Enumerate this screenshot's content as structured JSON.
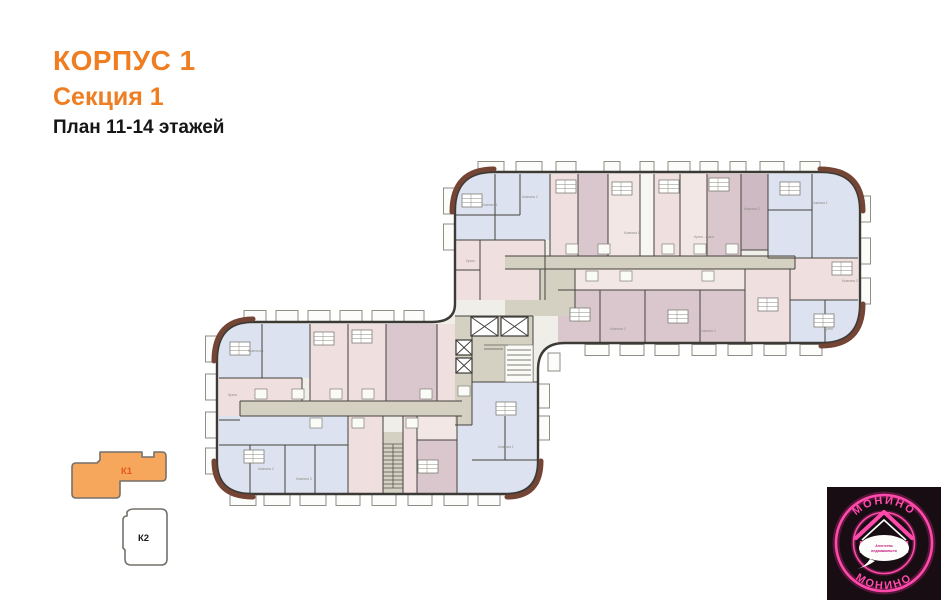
{
  "header": {
    "building": "КОРПУС 1",
    "section": "Секция 1",
    "floors": "План 11-14 этажей"
  },
  "minimap": {
    "k1_label": "К1",
    "k2_label": "К2"
  },
  "logo": {
    "arc_top": "МОНИНО",
    "arc_bottom": "МОНИНО",
    "tagline_line1": "Агентство",
    "tagline_line2": "недвижимости"
  },
  "plan": {
    "room_labels": [
      "Комната 1",
      "Комната 2",
      "Комната 3",
      "Кухня",
      "Кухня - ниша",
      "С/у"
    ],
    "colors": {
      "accent_orange": "#EE7E21",
      "k1_fill": "#F7A75C",
      "k1_label_color": "#E2591D",
      "base": "#EFEEE8",
      "apt_blue": "#DCE2EF",
      "apt_pink": "#EFDFDE",
      "apt_pink_light": "#F2E7E4",
      "apt_mauve": "#D9C7CD",
      "apt_mauve_dark": "#CEBAC2",
      "white_room": "#F7F6F2",
      "corridor": "#D4D1C2",
      "wall": "#45433E",
      "corner_brown": "#744434",
      "logo_bg": "#170D13",
      "logo_pink": "#FF2E9C",
      "logo_tagline": "#C2187C"
    }
  }
}
